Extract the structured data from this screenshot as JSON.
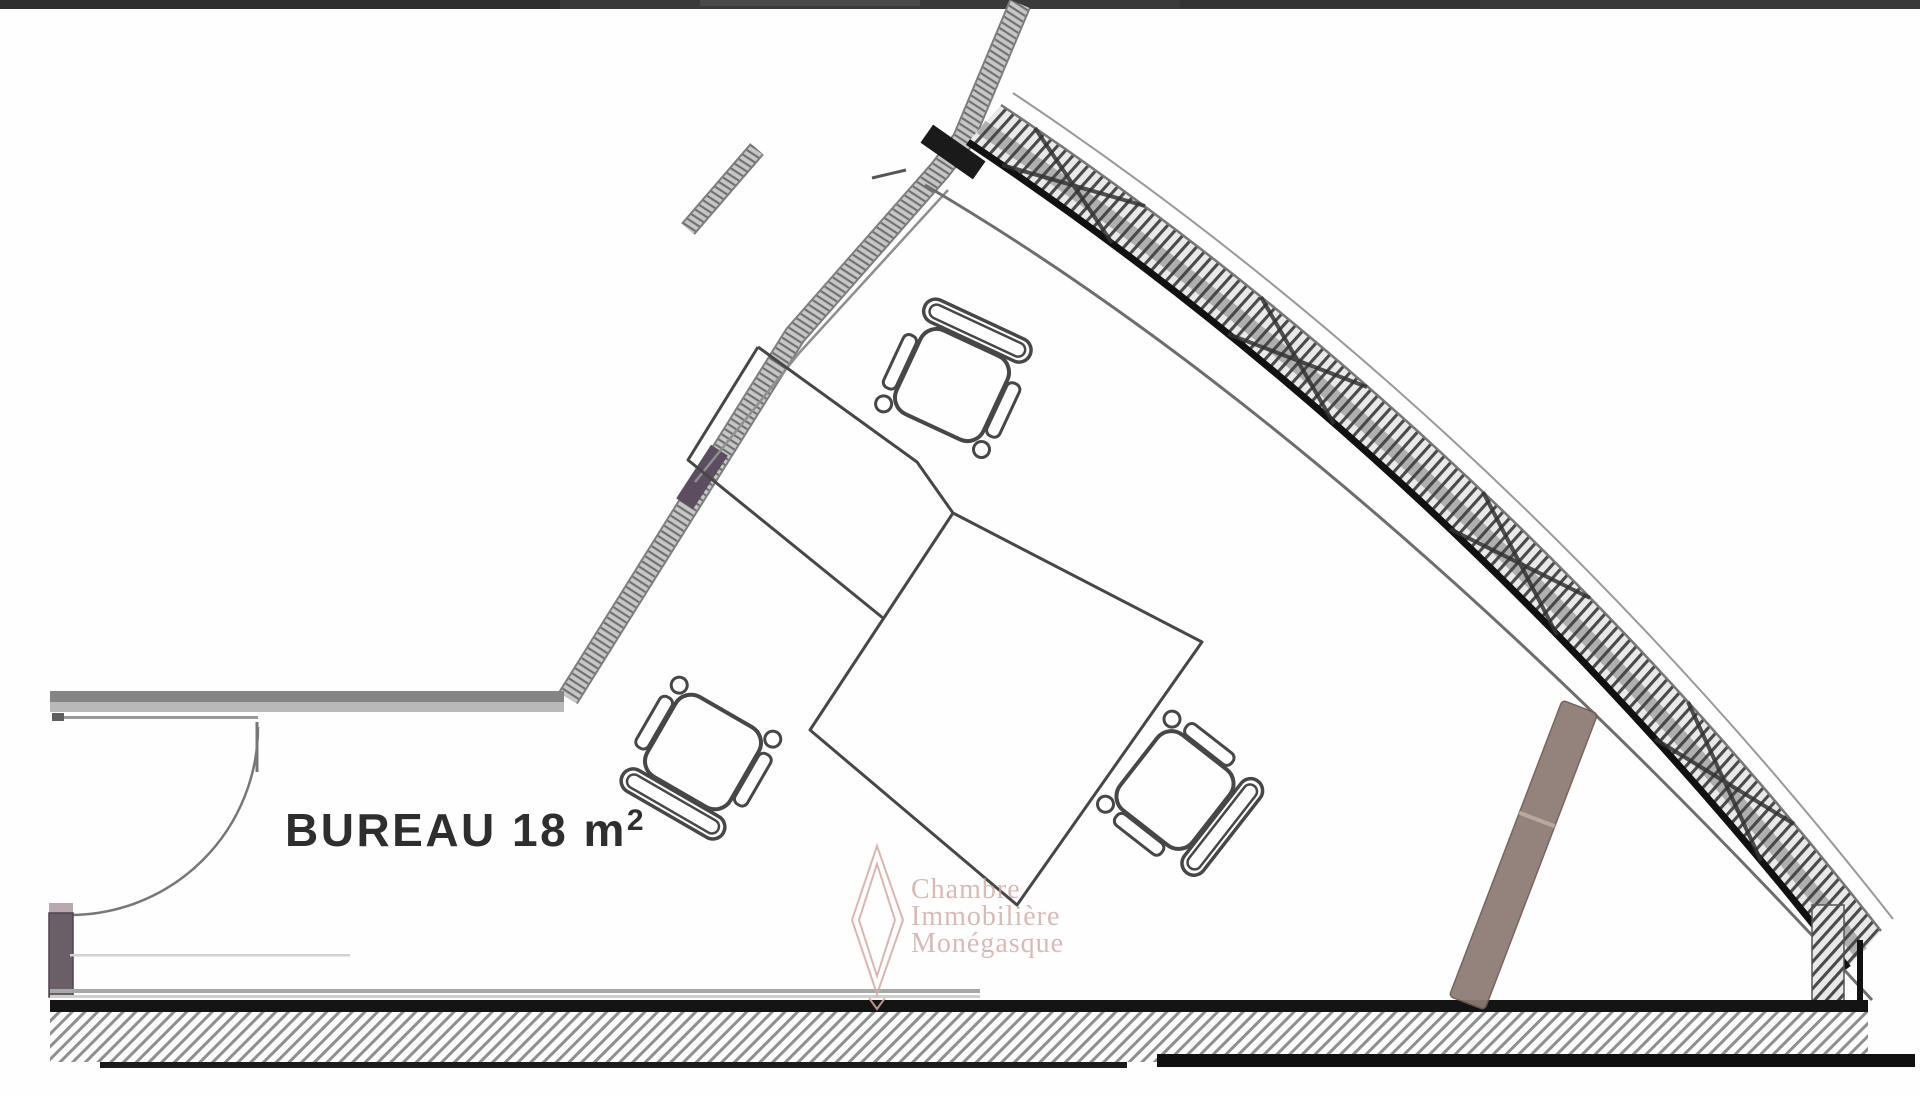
{
  "room": {
    "label": "BUREAU 18 m",
    "area_superscript": "2"
  },
  "watermark": {
    "line1": "Chambre",
    "line2": "Immobilière",
    "line3": "Monégasque",
    "logo": "double-diamond-icon"
  },
  "colors": {
    "watermark_pink": "#c7a19b",
    "watermark_logo_pink": "#d2aaa4",
    "wall_gray": "#bfbfbf",
    "wall_edge_gray": "#7d7d7d",
    "window_marker_purple": "#5c4e60",
    "beam_brown": "#8d7a73",
    "door_jamb_purple": "#6a5f66",
    "line_dark": "#1a1a1a",
    "furniture_line": "#474747"
  }
}
